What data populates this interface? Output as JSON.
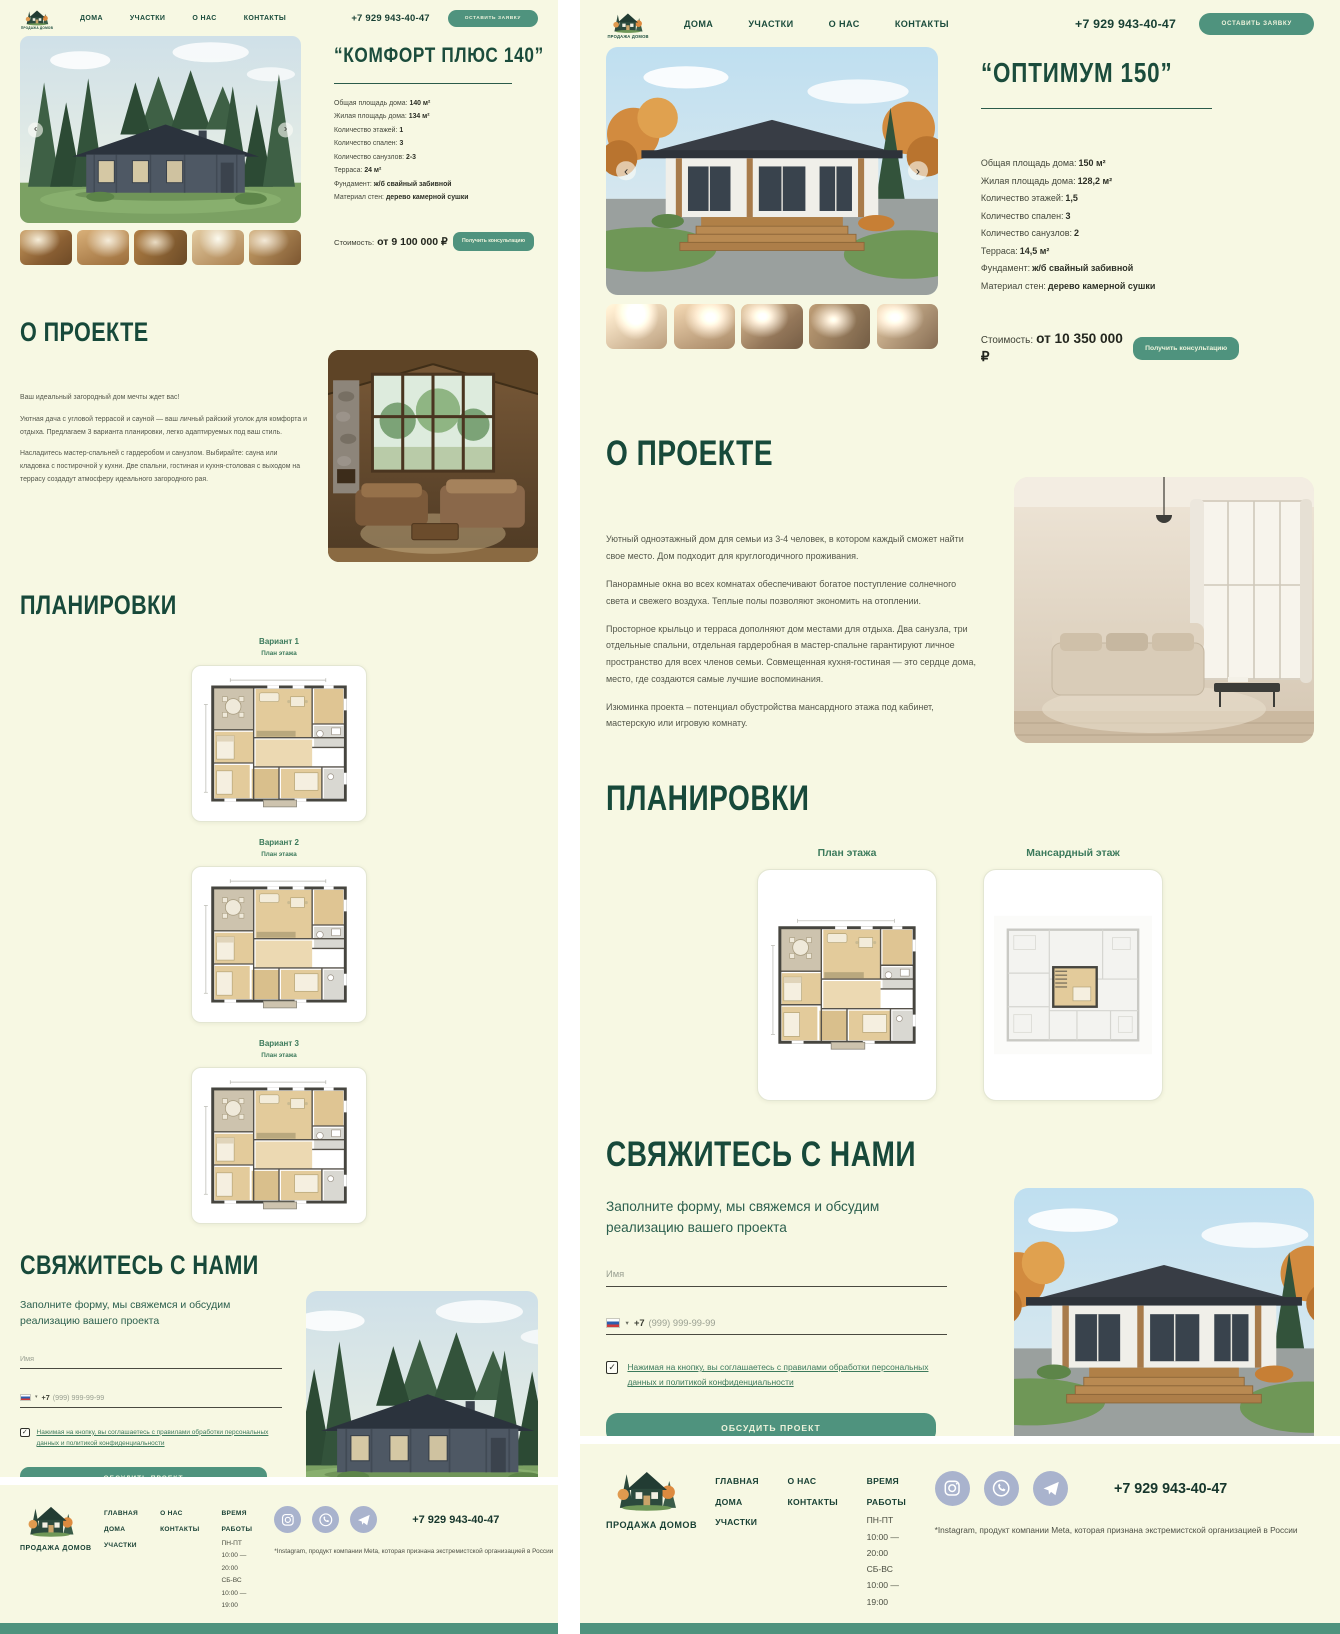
{
  "icons": {
    "chevron_left": "‹",
    "chevron_right": "›",
    "caret_down": "▾",
    "check": "✓"
  },
  "theme": {
    "background": "#f7f8e3",
    "heading_green": "#17493a",
    "teal": "#4f937e",
    "link_green": "#3c7a5c"
  },
  "header": {
    "logo_text": "ПРОДАЖА ДОМОВ",
    "nav": [
      "ДОМА",
      "УЧАСТКИ",
      "О НАС",
      "КОНТАКТЫ"
    ],
    "phone": "+7 929 943-40-47",
    "cta": "ОСТАВИТЬ ЗАЯВКУ"
  },
  "left_page": {
    "title": "“КОМФОРТ ПЛЮС 140”",
    "specs": [
      {
        "label": "Общая площадь дома:",
        "value": "140 м²"
      },
      {
        "label": "Жилая площадь дома:",
        "value": "134 м²"
      },
      {
        "label": "Количество этажей:",
        "value": "1"
      },
      {
        "label": "Количество спален:",
        "value": "3"
      },
      {
        "label": "Количество санузлов:",
        "value": "2-3"
      },
      {
        "label": "Терраса:",
        "value": "24 м²"
      },
      {
        "label": "Фундамент:",
        "value": "ж/б свайный забивной"
      },
      {
        "label": "Материал стен:",
        "value": "дерево камерной сушки"
      }
    ],
    "price_label": "Стоимость:",
    "price_value": "от 9 100 000 ₽",
    "consult_button": "Получить консультацию",
    "about_title": "О ПРОЕКТЕ",
    "about_paragraphs": [
      "Ваш идеальный загородный дом мечты ждет вас!",
      "Уютная дача с угловой террасой и сауной — ваш личный райский уголок для комфорта и отдыха. Предлагаем 3 варианта планировки, легко адаптируемых под ваш стиль.",
      "Насладитесь мастер-спальней с гардеробом и санузлом. Выбирайте: сауна или кладовка с постирочной у кухни. Две спальни, гостиная и кухня-столовая с выходом на террасу создадут атмосферу идеального загородного рая."
    ],
    "plans_title": "ПЛАНИРОВКИ",
    "plans": [
      {
        "title": "Вариант 1",
        "subtitle": "План этажа"
      },
      {
        "title": "Вариант 2",
        "subtitle": "План этажа"
      },
      {
        "title": "Вариант 3",
        "subtitle": "План этажа"
      }
    ]
  },
  "right_page": {
    "title": "“ОПТИМУМ 150”",
    "specs": [
      {
        "label": "Общая площадь дома:",
        "value": "150 м²"
      },
      {
        "label": "Жилая площадь дома:",
        "value": "128,2 м²"
      },
      {
        "label": "Количество этажей:",
        "value": "1,5"
      },
      {
        "label": "Количество спален:",
        "value": "3"
      },
      {
        "label": "Количество санузлов:",
        "value": "2"
      },
      {
        "label": "Терраса:",
        "value": "14,5 м²"
      },
      {
        "label": "Фундамент:",
        "value": "ж/б свайный забивной"
      },
      {
        "label": "Материал стен:",
        "value": "дерево камерной сушки"
      }
    ],
    "price_label": "Стоимость:",
    "price_value": "от 10 350 000 ₽",
    "consult_button": "Получить консультацию",
    "about_title": "О ПРОЕКТЕ",
    "about_paragraphs": [
      "Уютный одноэтажный дом для семьи из 3-4 человек, в котором каждый сможет найти свое место. Дом подходит для круглогодичного проживания.",
      "Панорамные окна во всех комнатах обеспечивают богатое поступление солнечного света и свежего воздуха. Теплые полы позволяют экономить на отоплении.",
      "Просторное крыльцо и терраса дополняют дом местами для отдыха. Два санузла, три отдельные спальни, отдельная гардеробная в мастер-спальне гарантируют личное пространство для всех членов семьи. Совмещенная кухня-гостиная — это сердце дома, место, где создаются самые лучшие воспоминания.",
      "Изюминка проекта – потенциал обустройства мансардного этажа под кабинет, мастерскую или игровую комнату."
    ],
    "plans_title": "ПЛАНИРОВКИ",
    "plans": [
      {
        "title": "План этажа"
      },
      {
        "title": "Мансардный этаж"
      }
    ]
  },
  "contact": {
    "title": "СВЯЖИТЕСЬ С НАМИ",
    "subtitle": "Заполните форму, мы свяжемся и обсудим реализацию вашего проекта",
    "name_placeholder": "Имя",
    "phone_prefix": "+7",
    "phone_placeholder": "(999) 999-99-99",
    "agreement": "Нажимая на кнопку, вы соглашаетесь с правилами обработки персональных данных и политикой конфиденциальности",
    "submit": "ОБСУДИТЬ ПРОЕКТ"
  },
  "footer": {
    "logo_text": "ПРОДАЖА ДОМОВ",
    "nav_col1": [
      "ГЛАВНАЯ",
      "ДОМА",
      "УЧАСТКИ"
    ],
    "nav_col2": [
      "О НАС",
      "КОНТАКТЫ"
    ],
    "hours_title": "ВРЕМЯ РАБОТЫ",
    "hours": [
      "ПН-ПТ 10:00 — 20:00",
      "СБ-ВС 10:00 — 19:00"
    ],
    "socials": [
      "instagram",
      "whatsapp",
      "telegram"
    ],
    "phone": "+7 929 943-40-47",
    "disclaimer": "*Instagram, продукт компании Meta, которая признана экстремистской организацией в России"
  }
}
